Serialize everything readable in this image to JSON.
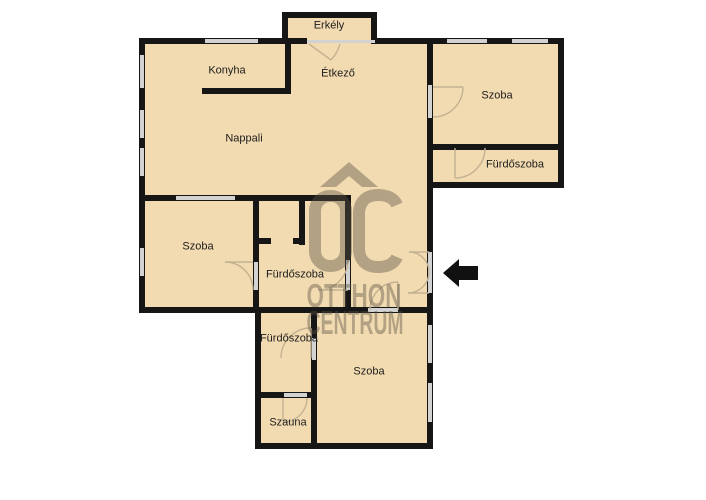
{
  "plan": {
    "type": "apartment-floor-plan",
    "rooms": {
      "erkely": {
        "label": "Erkély"
      },
      "konyha": {
        "label": "Konyha"
      },
      "etkezo": {
        "label": "Étkező"
      },
      "szoba_top_right": {
        "label": "Szoba"
      },
      "furdoszoba_top_right": {
        "label": "Fürdőszoba"
      },
      "nappali": {
        "label": "Nappali"
      },
      "szoba_left": {
        "label": "Szoba"
      },
      "furdoszoba_middle": {
        "label": "Fürdőszoba"
      },
      "furdoszoba_bottom": {
        "label": "Fürdőszoba"
      },
      "szoba_bottom": {
        "label": "Szoba"
      },
      "szauna": {
        "label": "Szauna"
      }
    },
    "icons": {
      "entrance_arrow": "black arrow pointing left at the entry door"
    },
    "colors": {
      "floor": "#f3dbb1",
      "wall": "#161616",
      "window_opening": "#d2d2d2",
      "door_arc": "#c2b192",
      "label_text": "#1c1c1c",
      "watermark": "#5a5344",
      "background": "#ffffff"
    }
  },
  "watermark": {
    "logo": "OC",
    "line2": "OTTHON",
    "line3": "CENTRUM"
  }
}
